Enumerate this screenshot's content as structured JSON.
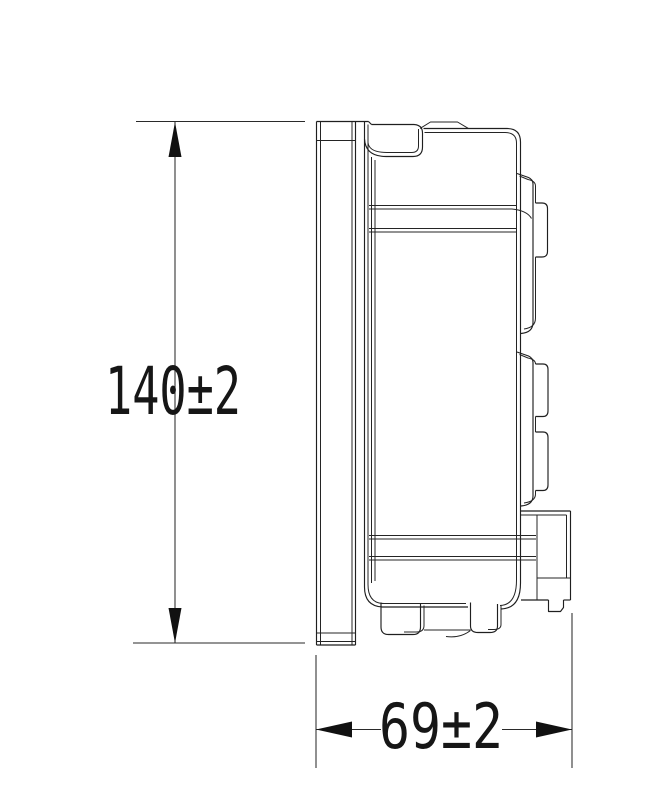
{
  "drawing": {
    "kind": "engineering dimension drawing, side view",
    "background_color": "#ffffff",
    "line_color": "#1f1f1f",
    "text_color": "#161616",
    "dimensions": {
      "height": {
        "label": "140±2",
        "nominal": 140,
        "tolerance": "±2",
        "orientation": "vertical"
      },
      "depth": {
        "label": "69±2",
        "nominal": 69,
        "tolerance": "±2",
        "orientation": "horizontal"
      }
    }
  }
}
